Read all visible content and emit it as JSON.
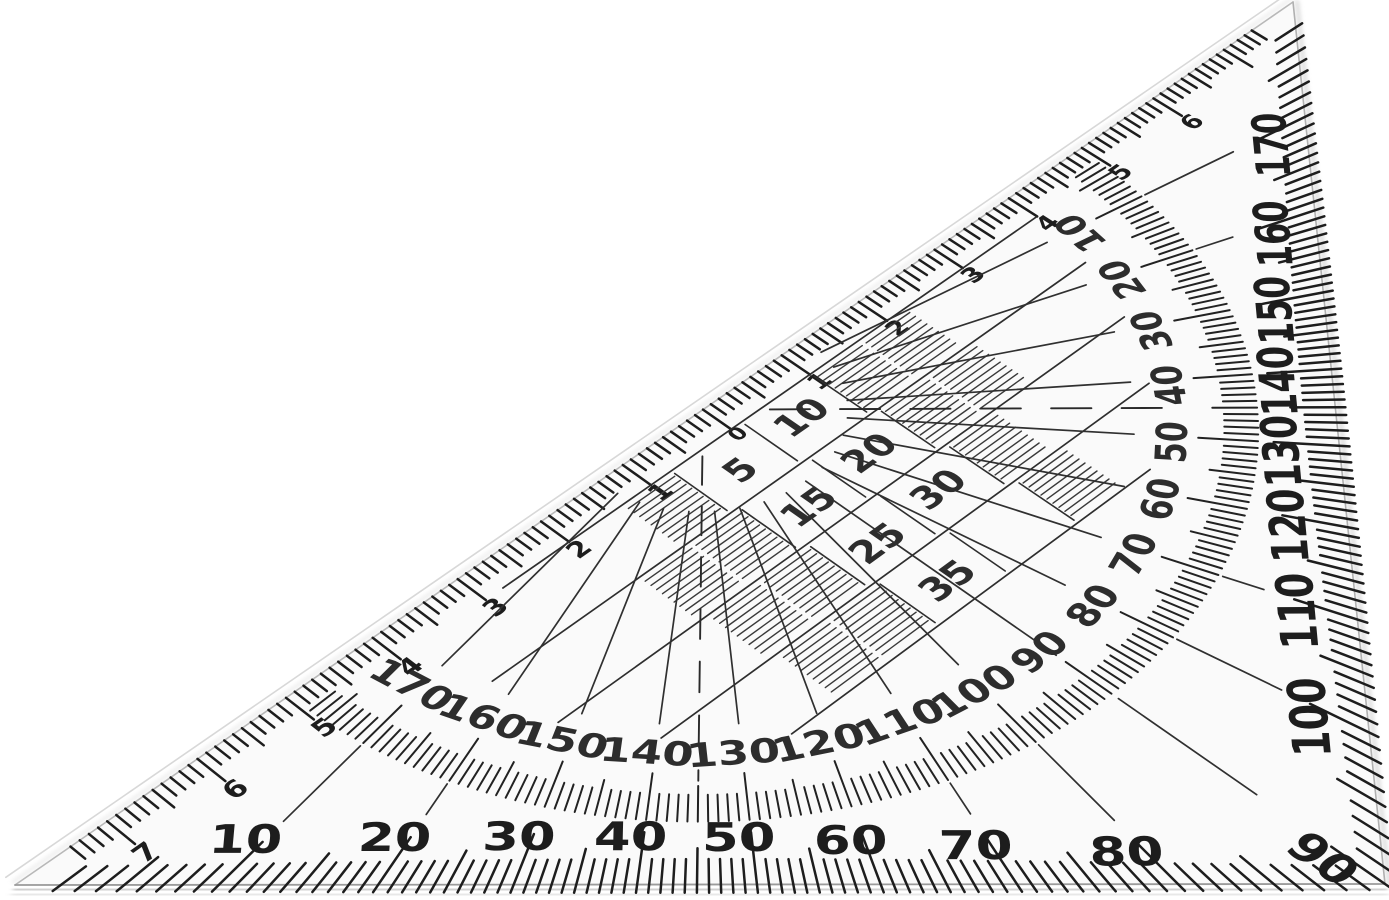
{
  "scene": {
    "description": "Transparent triangular set square (protractor ruler) photographed on a white background"
  },
  "colors": {
    "background": "#ffffff",
    "plastic": "#fafafa",
    "ink": "#1d1d1d",
    "ink_soft": "#2d2d2d",
    "edge_line": "#a6a6a6",
    "bevel": "#d8d8d8",
    "shadow": "#8f8f8f"
  },
  "protractor": {
    "bottom_edge_degree_labels": [
      "10",
      "20",
      "30",
      "40",
      "50",
      "60",
      "70",
      "80"
    ],
    "corner_degree_label": "90",
    "right_edge_degree_labels": [
      "100",
      "110",
      "120",
      "130",
      "140",
      "150",
      "160",
      "170"
    ],
    "inner_ring_degree_labels": [
      "10",
      "20",
      "30",
      "40",
      "50",
      "60",
      "70",
      "80",
      "90",
      "100",
      "110",
      "120",
      "130",
      "140",
      "150",
      "160",
      "170"
    ],
    "tick_interval_degrees": 1,
    "label_interval_degrees": 10
  },
  "ruler": {
    "zero_label": "0",
    "upper_cm_labels": [
      "1",
      "2",
      "3",
      "4",
      "5",
      "6"
    ],
    "lower_cm_labels": [
      "1",
      "2",
      "3",
      "4",
      "5",
      "6",
      "7"
    ],
    "millimeter_ticks": true
  },
  "parallel_grid": {
    "labels": [
      "5",
      "10",
      "15",
      "20",
      "25",
      "30",
      "35"
    ],
    "unit": "mm"
  }
}
